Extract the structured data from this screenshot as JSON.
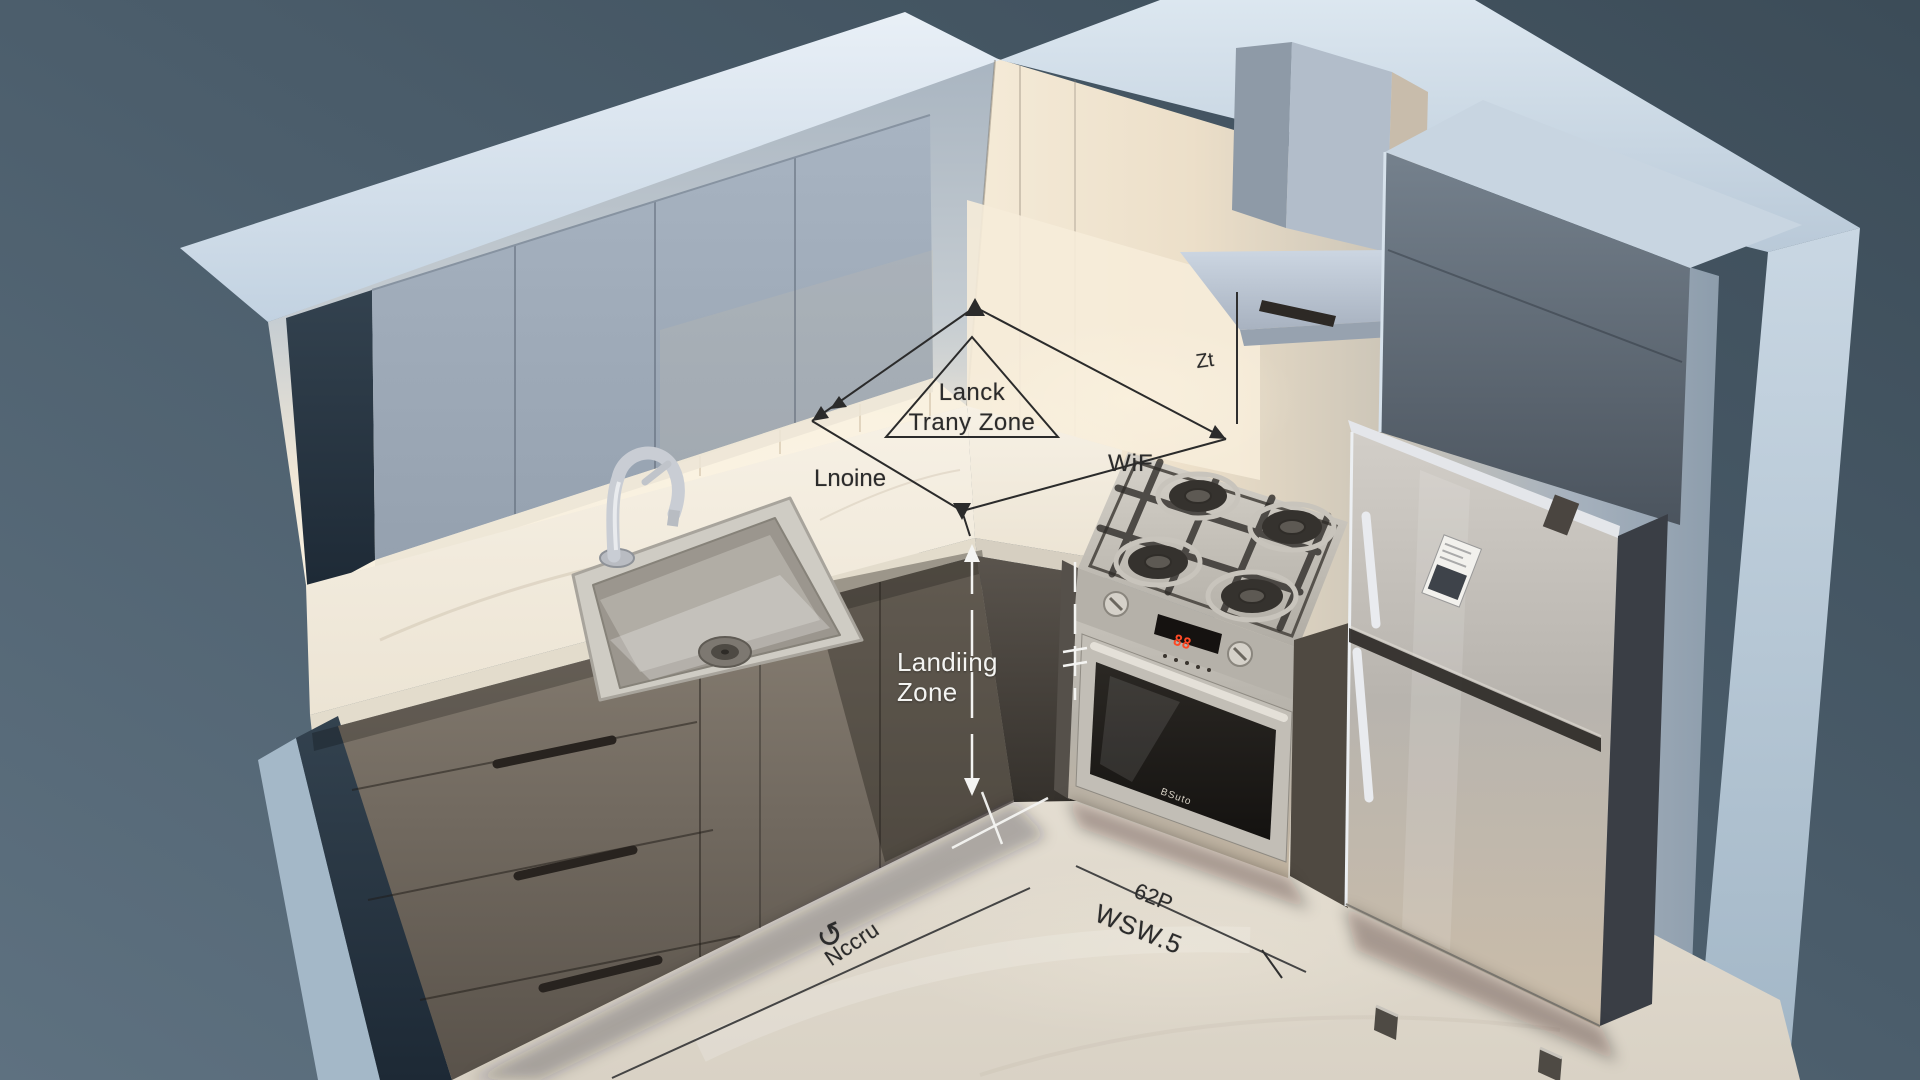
{
  "annotations": {
    "triangle_label": {
      "line1": "Lanck",
      "line2": "Trany Zone"
    },
    "counter_label_left": "Lnoine",
    "counter_label_right": "WiF",
    "backsplash_dim_label": "Zt",
    "landing_zone": {
      "line1": "Landiing",
      "line2": "Zone"
    },
    "floor_dim_label_small": "62P",
    "floor_dim_label_large": "WSW.5",
    "floor_label": "Nccru",
    "rotate_icon_glyph": "↺",
    "oven_brand": "BSuto"
  },
  "colors": {
    "background_top": "#3c4c58",
    "background_bottom": "#5e7180",
    "wall_edge": "#d8e4ef",
    "upper_cabinet": "#a3afbd",
    "base_cabinet": "#6f675d",
    "counter": "#f4eee2",
    "floor": "#e9e3d8",
    "appliance_steel": "#c3bfb7",
    "annotation_dark": "#2b2b2b",
    "annotation_light": "#f4f4f2",
    "oven_display_red": "#ff4a26"
  }
}
